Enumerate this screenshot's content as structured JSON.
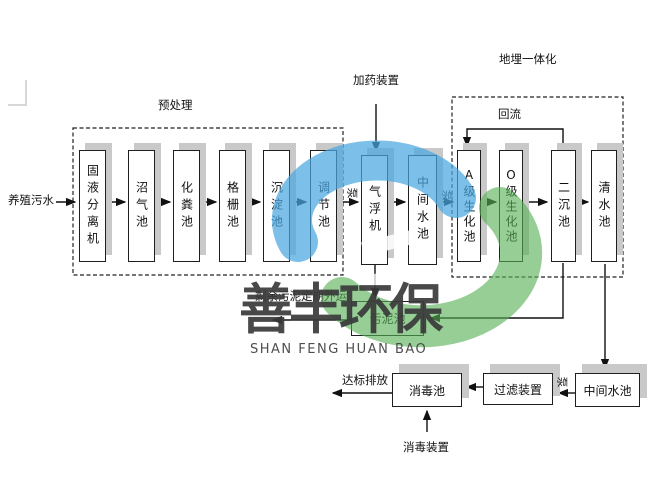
{
  "annotations": {
    "influent": "养殖污水",
    "pretreatment": "预处理",
    "dosing_device": "加药装置",
    "buried_integration": "地埋一体化",
    "reflux": "回流",
    "sludge_out": "剩余污泥定期外运",
    "discharge": "达标排放",
    "disinfection_device": "消毒装置",
    "pump": "泵"
  },
  "row1_boxes": [
    "固液分离机",
    "沼气池",
    "化粪池",
    "格栅池",
    "沉淀池",
    "调节池",
    "气浮机",
    "中间水池",
    "A级生化池",
    "O级生化池",
    "二沉池",
    "清水池"
  ],
  "other_boxes": {
    "sludge": "污泥池",
    "disinfection": "消毒池",
    "filter": "过滤装置",
    "intermediate": "中间水池"
  },
  "watermark": {
    "cn": "善丰环保",
    "en": "SHAN FENG HUAN BAO"
  },
  "colors": {
    "logo_blue": "#4aa8e0",
    "logo_green": "#55b055",
    "box_shadow": "#c9c9c9",
    "line_ink": "#1a1a1a",
    "watermark_text": "#3a3a3a"
  }
}
